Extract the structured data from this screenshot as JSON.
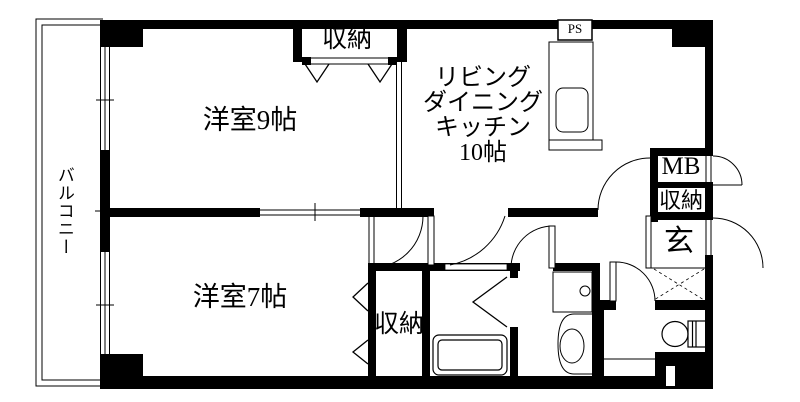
{
  "floorplan": {
    "balcony": "バルコニー",
    "bedroom9": "洋室9帖",
    "bedroom7": "洋室7帖",
    "ldk": "リビング\nダイニング\nキッチン\n10帖",
    "closet_top": "収納",
    "closet_bottom": "収納",
    "closet_entrance": "収納",
    "genkan": "玄",
    "ps": "PS",
    "mb": "MB"
  }
}
